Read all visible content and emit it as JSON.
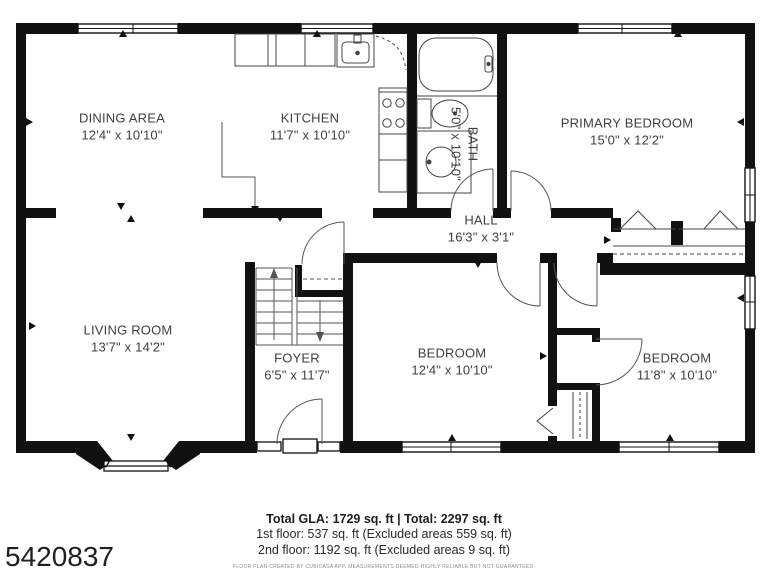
{
  "rooms": [
    {
      "name": "DINING AREA",
      "dims": "12'4\" x 10'10\""
    },
    {
      "name": "KITCHEN",
      "dims": "11'7\" x 10'10\""
    },
    {
      "name": "BATH",
      "dims": "5'0\" x 10'10\""
    },
    {
      "name": "PRIMARY BEDROOM",
      "dims": "15'0\" x 12'2\""
    },
    {
      "name": "HALL",
      "dims": "16'3\" x 3'1\""
    },
    {
      "name": "LIVING ROOM",
      "dims": "13'7\" x 14'2\""
    },
    {
      "name": "FOYER",
      "dims": "6'5\" x 11'7\""
    },
    {
      "name": "BEDROOM",
      "dims": "12'4\" x 10'10\""
    },
    {
      "name": "BEDROOM",
      "dims": "11'8\" x 10'10\""
    }
  ],
  "summary": {
    "total_line": "Total GLA: 1729 sq. ft | Total: 2297 sq. ft",
    "first_floor_line": "1st floor: 537 sq. ft (Excluded areas 559 sq. ft)",
    "second_floor_line": "2nd floor: 1192 sq. ft (Excluded areas 9 sq. ft)"
  },
  "disclaimer": "FLOOR PLAN CREATED BY CUBICASA APP. MEASUREMENTS DEEMED HIGHLY RELIABLE BUT NOT GUARANTEED.",
  "mls_number": "5420837",
  "colors": {
    "wall": "#111111",
    "label_text": "#3f3f3f",
    "summary_text": "#1c1c1c",
    "disclaimer_text": "#8c8c8c"
  }
}
